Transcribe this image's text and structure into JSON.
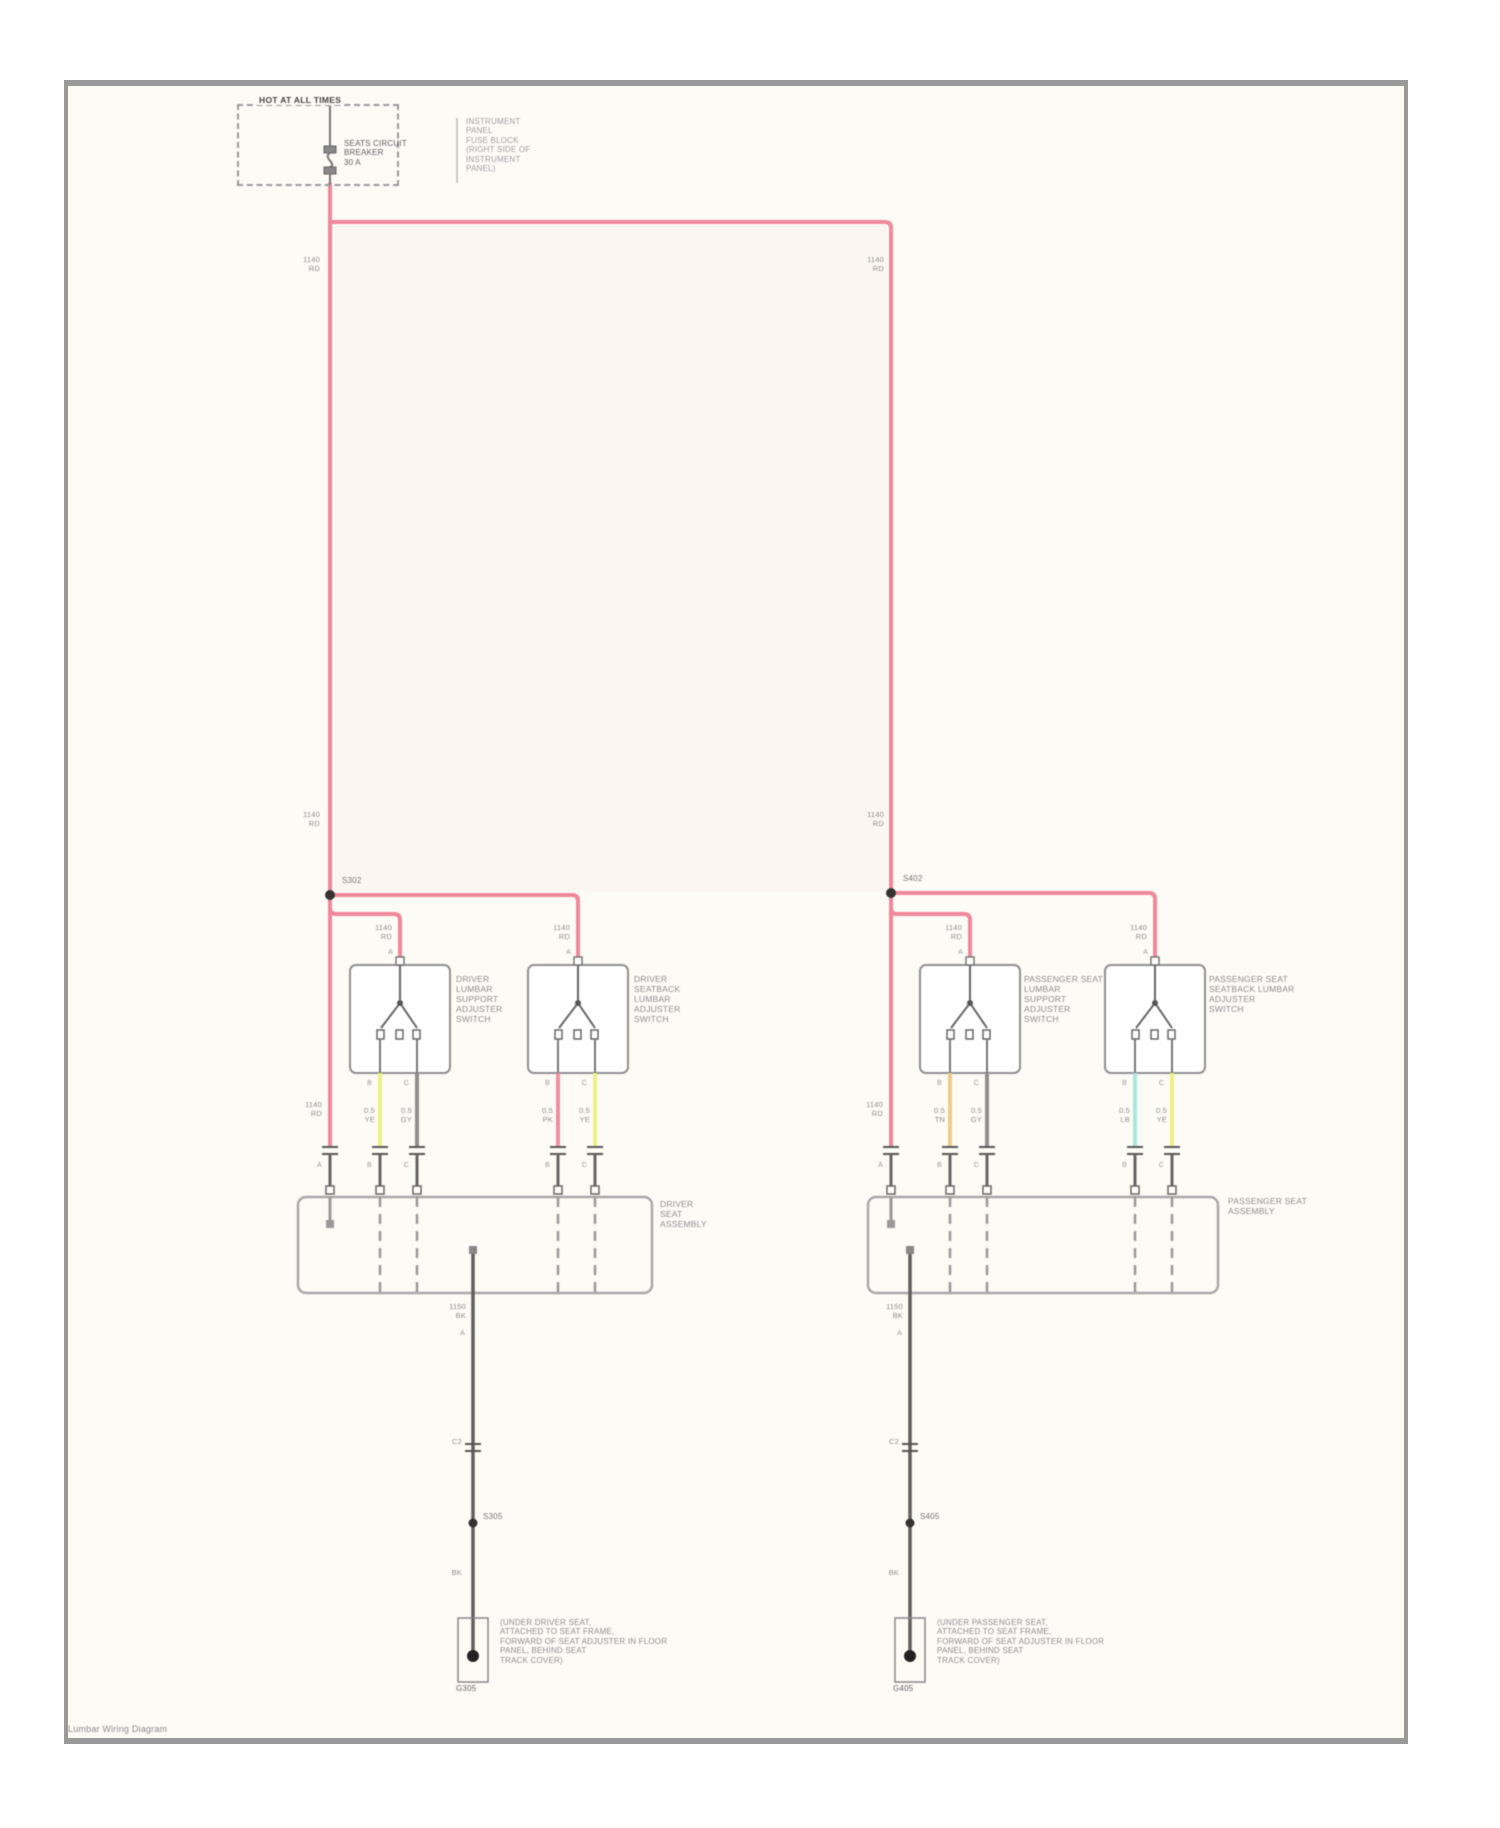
{
  "page": {
    "caption": "Lumbar Wiring Diagram",
    "banner": "HOT AT ALL TIMES"
  },
  "fuse_block": {
    "callout": "INSTRUMENT\nPANEL\nFUSE BLOCK\n(RIGHT SIDE OF\nINSTRUMENT\nPANEL)",
    "fuse": "SEATS CIRCUIT\nBREAKER\n30 A"
  },
  "wires": {
    "power": "1140\nRD",
    "ground_top": "1150\nBK",
    "ground_code": "BK",
    "inline_connector": "C2",
    "outputs": {
      "l1_left": "0.5\nYE",
      "l1_right": "0.5\nGY",
      "l2_left": "0.5\nPK",
      "l2_right": "0.5\nYE",
      "r1_left": "0.5\nTN",
      "r1_right": "0.5\nGY",
      "r2_left": "0.5\nLB",
      "r2_right": "0.5\nYE"
    }
  },
  "splices": {
    "left_power": "S302",
    "right_power": "S402",
    "left_ground": "S305",
    "right_ground": "S405"
  },
  "pins": {
    "a": "A",
    "b": "B",
    "c": "C"
  },
  "switches": {
    "l1": "DRIVER\nLUMBAR\nSUPPORT\nADJUSTER\nSWITCH",
    "l2": "DRIVER\nSEATBACK\nLUMBAR\nADJUSTER\nSWITCH",
    "r1": "PASSENGER SEAT\nLUMBAR\nSUPPORT\nADJUSTER\nSWITCH",
    "r2": "PASSENGER SEAT\nSEATBACK LUMBAR\nADJUSTER\nSWITCH"
  },
  "seats": {
    "left": "DRIVER\nSEAT\nASSEMBLY",
    "right": "PASSENGER SEAT\nASSEMBLY"
  },
  "grounds": {
    "left": {
      "code": "G305",
      "callout": "(UNDER DRIVER SEAT,\nATTACHED TO SEAT FRAME,\nFORWARD OF SEAT ADJUSTER IN FLOOR\nPANEL, BEHIND SEAT\nTRACK COVER)"
    },
    "right": {
      "code": "G405",
      "callout": "(UNDER PASSENGER SEAT,\nATTACHED TO SEAT FRAME,\nFORWARD OF SEAT ADJUSTER IN FLOOR\nPANEL, BEHIND SEAT\nTRACK COVER)"
    }
  },
  "colors": {
    "power": "#f0879a",
    "yellow": "#edef85",
    "pink": "#f08fa2",
    "tan": "#eccc8a",
    "cyan": "#a9e8de",
    "gray_wire": "#8f8f8f",
    "ground_wire": "#606060"
  }
}
